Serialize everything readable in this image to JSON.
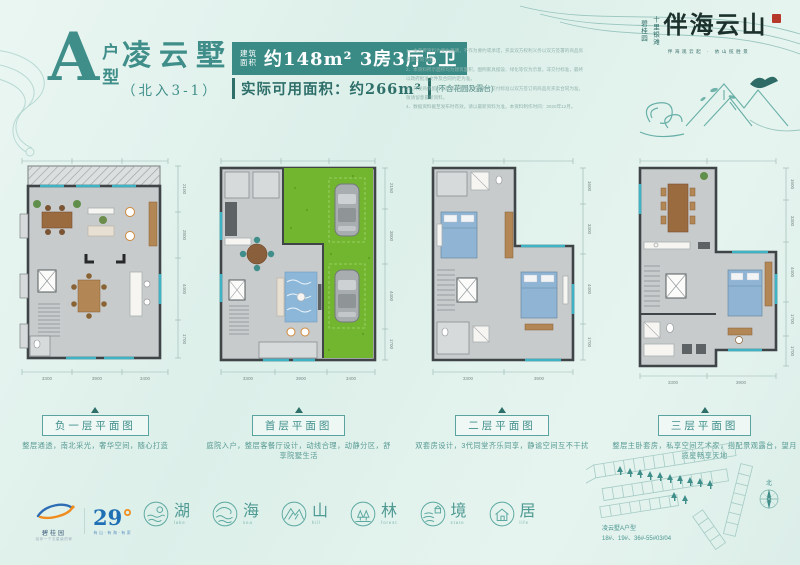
{
  "header": {
    "type_letter": "A",
    "type_char_top": "户",
    "type_char_bottom": "型",
    "villa_name": "凌云墅",
    "entrance": "（北入3-1）",
    "badge_pre_1": "建筑",
    "badge_pre_2": "面积",
    "badge_main": "约148m² 3房3厅5卫",
    "usable_main": "实际可用面积：约266m²",
    "usable_note": "(不含花园及露台)",
    "disclaimers": [
      "1、本宣传资料为要约邀请，不作为要约或承诺，买卖双方权利义务以双方签署的商品房买卖合同为准。",
      "2、本资料所示面积均为建筑面积，图例家具摆设、绿化等仅为示意，非交付标准，最终以政府批准文件及合同约定为准。",
      "3、开发商保留对本宣传资料修改的权利，交付标准以双方签订的商品房买卖合同为准，敬请留意最新资料。",
      "4、数据资料截至发布时有效，请以最新资料为准，本资料制作时间：2020年12月。"
    ]
  },
  "brand": {
    "vertical_1": "十里银滩",
    "vertical_2": "碧桂园",
    "logo": "伴海云山",
    "tagline": "伴海观云起 · 依山揽胜景"
  },
  "plans": [
    {
      "caption": "负一层平面图",
      "desc": "整层通透，南北采光，奢华空间，随心打造",
      "dims_bottom": [
        "3300",
        "3900",
        "3400"
      ],
      "dims_right": [
        "2100",
        "2800",
        "4400",
        "1700"
      ]
    },
    {
      "caption": "首层平面图",
      "desc": "庭院入户，整层客餐厅设计，动线合理，动静分区，舒享院墅生活",
      "dims_bottom": [
        "3300",
        "3900",
        "3400"
      ],
      "dims_right": [
        "2150",
        "3800",
        "4400",
        "1700"
      ]
    },
    {
      "caption": "二层平面图",
      "desc": "双套房设计，3代同堂齐乐同享，静谧空间互不干扰",
      "dims_bottom": [
        "3300",
        "3900"
      ],
      "dims_right": [
        "1600",
        "3300",
        "4400",
        "1700"
      ]
    },
    {
      "caption": "三层平面图",
      "desc": "整层主卧套房，私享空间艺术家，搭配景观露台，望月揽星畅享天地",
      "dims_bottom": [
        "3300",
        "3900"
      ],
      "dims_right": [
        "1600",
        "3300",
        "4400",
        "1700",
        "1700"
      ]
    }
  ],
  "features": [
    {
      "char": "湖",
      "en": "lake"
    },
    {
      "char": "海",
      "en": "sea"
    },
    {
      "char": "山",
      "en": "hill"
    },
    {
      "char": "林",
      "en": "forest"
    },
    {
      "char": "境",
      "en": "state"
    },
    {
      "char": "居",
      "en": "life"
    }
  ],
  "footer": {
    "cg_name": "碧桂园",
    "cg_sub": "给你一个五星级的家",
    "temp_value": "29",
    "temp_degree": "°",
    "temp_sub": "有山·有海·有家",
    "sitemap_line1": "凌云墅A户型",
    "sitemap_line2": "18#、19#、36#-55#03/04",
    "compass_label": "北"
  },
  "colors": {
    "accent_teal": "#3f8e8a",
    "badge_bg": "#3a8b86",
    "calligraphy": "#1c302c",
    "seal_red": "#b5382a",
    "garden_green": "#72b52e",
    "bed_blue": "#8fb4d4",
    "temp_blue": "#1f6fb5",
    "temp_orange": "#f08c1e"
  }
}
